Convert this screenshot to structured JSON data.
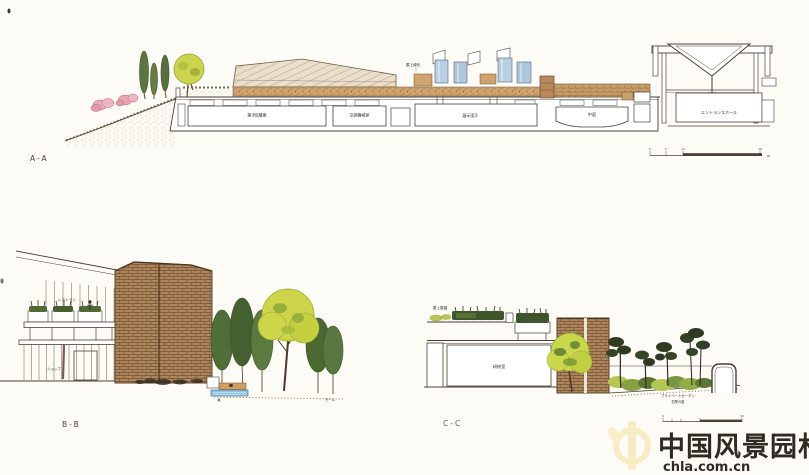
{
  "sections": {
    "a": {
      "label": "A-A",
      "roof_label": "屋上緑化",
      "rooms": {
        "storage": "第3収蔵庫",
        "machine": "空調機械室",
        "exhibition": "展示室2",
        "courtyard": "中庭",
        "entrance_hall": "エントランスホール"
      },
      "scale": {
        "ticks": [
          "0",
          "5",
          "10",
          "20"
        ],
        "unit": "m"
      }
    },
    "b": {
      "label": "B-B",
      "restaurant": "レストラン",
      "shop": "ショップ",
      "lobby": "ロビー",
      "waterfall": "滝",
      "mall": "モール"
    },
    "c": {
      "label": "C-C",
      "roof_garden": "屋上庭園",
      "room": "研修室",
      "private_garden": "プライベートガーデン",
      "private_garden_sub": "四季の庭",
      "scale": {
        "ticks": [
          "0",
          "20"
        ]
      }
    }
  },
  "watermark": {
    "site_name": "中国风景园林网",
    "site_url": "chla.com.cn",
    "color": "#f6edc3"
  },
  "colors": {
    "paper": "#fcfbf6",
    "ink": "#4a4038",
    "brick": "#b28a5f",
    "soil": "#cfa46e",
    "glass_blue": "#b9cfe2",
    "tree_green": "#4f6d36",
    "tree_yellow": "#ccd648",
    "shrub_pink": "#e8a8b4",
    "water_blue": "#8fc5e2"
  }
}
